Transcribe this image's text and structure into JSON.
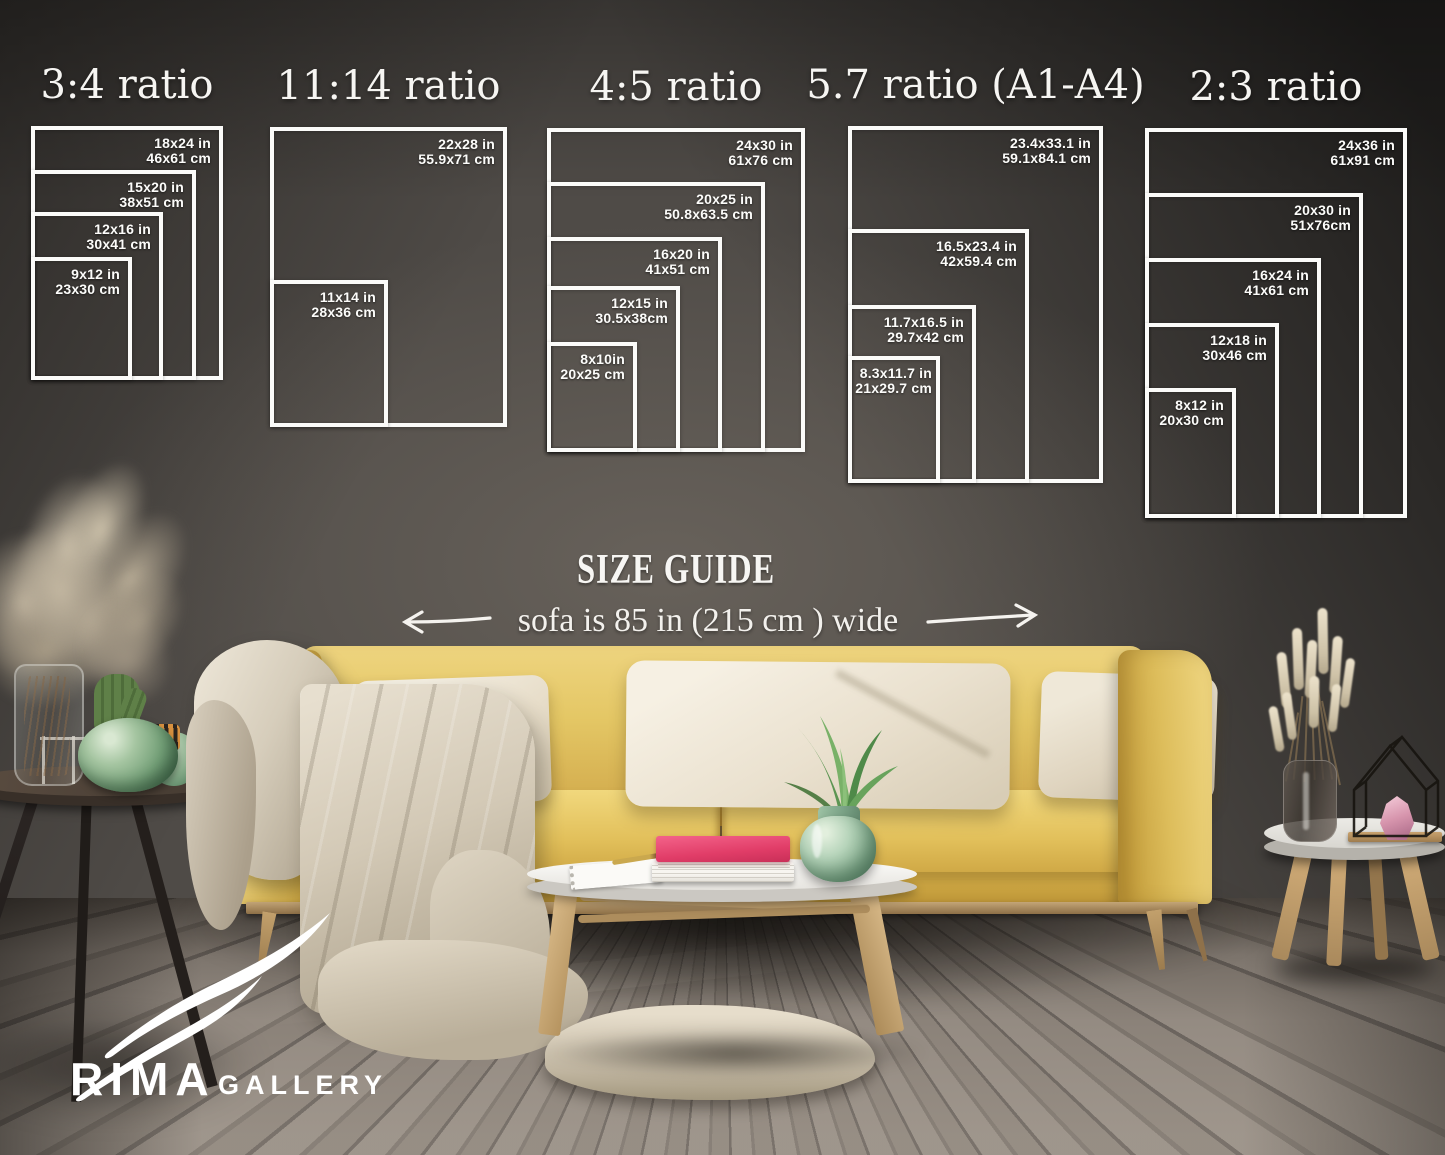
{
  "heading": {
    "title": "SIZE GUIDE",
    "sofa_note": "sofa is 85 in (215 cm ) wide"
  },
  "ratios": [
    {
      "title": "3:4 ratio",
      "frames": [
        {
          "in": "18x24 in",
          "cm": "46x61 cm"
        },
        {
          "in": "15x20 in",
          "cm": "38x51 cm"
        },
        {
          "in": "12x16 in",
          "cm": "30x41 cm"
        },
        {
          "in": "9x12 in",
          "cm": "23x30 cm"
        }
      ]
    },
    {
      "title": "11:14 ratio",
      "frames": [
        {
          "in": "22x28 in",
          "cm": "55.9x71 cm"
        },
        {
          "in": "11x14 in",
          "cm": "28x36 cm"
        }
      ]
    },
    {
      "title": "4:5 ratio",
      "frames": [
        {
          "in": "24x30 in",
          "cm": "61x76 cm"
        },
        {
          "in": "20x25 in",
          "cm": "50.8x63.5 cm"
        },
        {
          "in": "16x20 in",
          "cm": "41x51 cm"
        },
        {
          "in": "12x15 in",
          "cm": "30.5x38cm"
        },
        {
          "in": "8x10in",
          "cm": "20x25 cm"
        }
      ]
    },
    {
      "title": "5.7 ratio (A1-A4)",
      "frames": [
        {
          "in": "23.4x33.1 in",
          "cm": "59.1x84.1 cm"
        },
        {
          "in": "16.5x23.4 in",
          "cm": "42x59.4 cm"
        },
        {
          "in": "11.7x16.5 in",
          "cm": "29.7x42 cm"
        },
        {
          "in": "8.3x11.7 in",
          "cm": "21x29.7 cm"
        }
      ]
    },
    {
      "title": "2:3 ratio",
      "frames": [
        {
          "in": "24x36 in",
          "cm": "61x91 cm"
        },
        {
          "in": "20x30 in",
          "cm": "51x76cm"
        },
        {
          "in": "16x24 in",
          "cm": "41x61 cm"
        },
        {
          "in": "12x18 in",
          "cm": "30x46 cm"
        },
        {
          "in": "8x12 in",
          "cm": "20x30 cm"
        }
      ]
    }
  ],
  "logo": {
    "brand": "RIMA",
    "suffix": "GALLERY"
  },
  "icons": {
    "left_arrow": "left-width-arrow",
    "right_arrow": "right-width-arrow",
    "swoosh": "rima-swoosh"
  },
  "colors": {
    "sofa": "#e3c464",
    "wall": "#4f4b47",
    "frame_line": "#fbfbf9",
    "book": "#e13d68",
    "vase_green": "#86ae90"
  }
}
